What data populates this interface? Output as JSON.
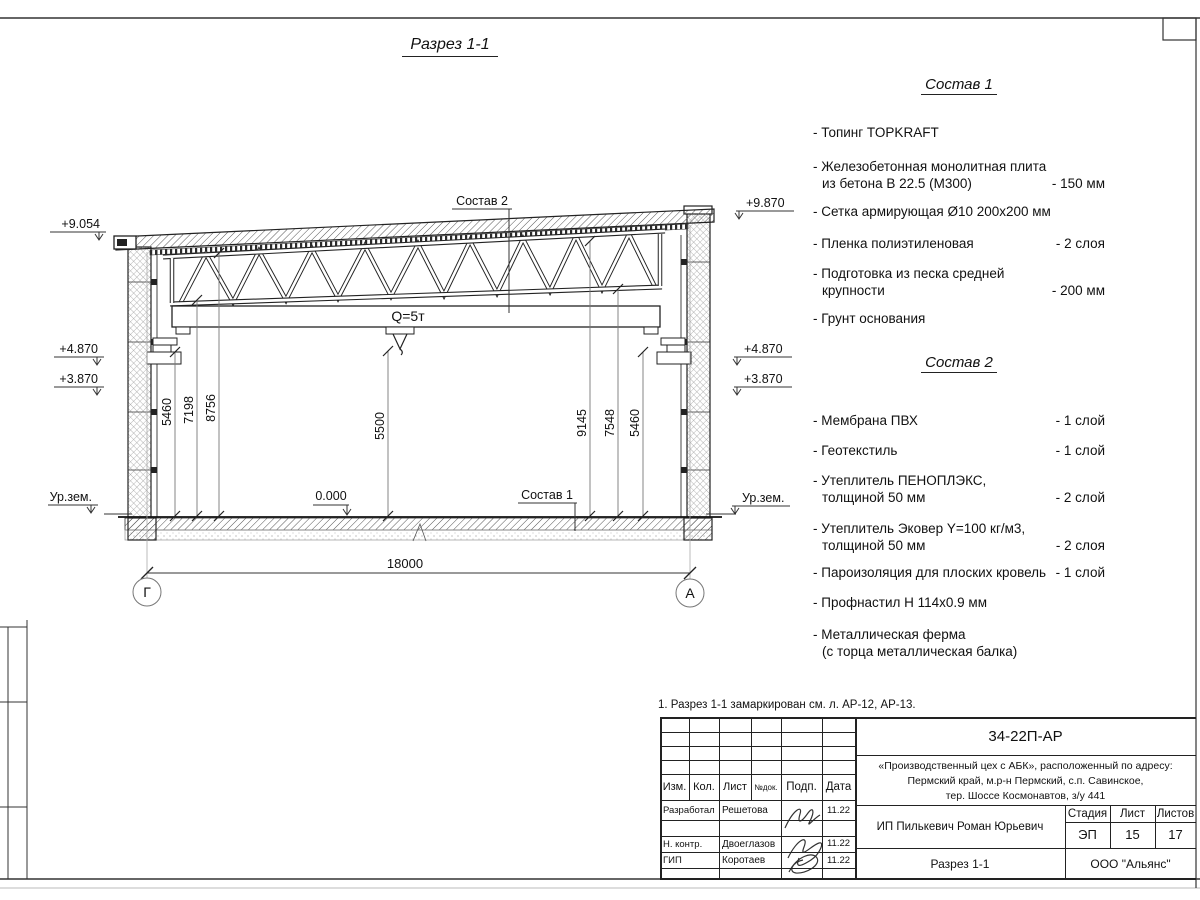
{
  "sheet": {
    "title": "Разрез 1-1",
    "note": "1. Разрез 1-1 замаркирован см. л. АР-12, АР-13."
  },
  "drawing": {
    "crane": "Q=5т",
    "span": "18000",
    "zero": "0.000",
    "axis_left": "Г",
    "axis_right": "А",
    "label_sostav1": "Состав 1",
    "label_sostav2": "Состав 2",
    "elev_left": [
      "+9.054",
      "+4.870",
      "+3.870",
      "Ур.зем."
    ],
    "elev_right": [
      "+9.870",
      "+4.870",
      "+3.870",
      "Ур.зем."
    ],
    "dims_left": [
      "5460",
      "7198",
      "8756"
    ],
    "dim_mid": "5500",
    "dims_right": [
      "9145",
      "7548",
      "5460"
    ]
  },
  "sostav1": {
    "title": "Состав 1",
    "items": [
      {
        "l1": "- Топинг TOPKRAFT",
        "l2": "",
        "value": ""
      },
      {
        "l1": "- Железобетонная  монолитная плита",
        "l2": "из бетона В 22.5 (М300)",
        "value": "- 150 мм"
      },
      {
        "l1": "- Сетка армирующая Ø10 200х200 мм",
        "l2": "",
        "value": ""
      },
      {
        "l1": "- Пленка полиэтиленовая",
        "l2": "",
        "value": "- 2 слоя"
      },
      {
        "l1": "- Подготовка из песка средней",
        "l2": "крупности",
        "value": "- 200 мм"
      },
      {
        "l1": "- Грунт основания",
        "l2": "",
        "value": ""
      }
    ]
  },
  "sostav2": {
    "title": "Состав 2",
    "items": [
      {
        "l1": "- Мембрана ПВХ",
        "l2": "",
        "value": "- 1 слой"
      },
      {
        "l1": "- Геотекстиль",
        "l2": "",
        "value": "- 1 слой"
      },
      {
        "l1": "- Утеплитель ПЕНОПЛЭКС,",
        "l2": "толщиной 50 мм",
        "value": "- 2 слой"
      },
      {
        "l1": "- Утеплитель Эковер Y=100 кг/м3,",
        "l2": "толщиной 50 мм",
        "value": "- 2 слоя"
      },
      {
        "l1": "- Пароизоляция для плоских кровель",
        "l2": "",
        "value": "- 1 слой"
      },
      {
        "l1": "- Профнастил Н 114х0.9 мм",
        "l2": "",
        "value": ""
      },
      {
        "l1": "- Металлическая ферма",
        "l2": "(с торца металлическая балка)",
        "value": ""
      }
    ]
  },
  "titleblock": {
    "doc_number": "34-22П-АР",
    "project": [
      "«Производственный цех с АБК», расположенный по адресу:",
      "Пермский край, м.р-н Пермский, с.п. Савинское,",
      "тер. Шоссе Космонавтов, з/у 441"
    ],
    "columns": [
      "Изм.",
      "Кол.",
      "Лист",
      "№док.",
      "Подп.",
      "Дата"
    ],
    "rows": [
      {
        "role": "Разработал",
        "name": "Решетова",
        "date": "11.22"
      },
      {
        "role": "Н. контр.",
        "name": "Двоеглазов",
        "date": "11.22"
      },
      {
        "role": "ГИП",
        "name": "Коротаев",
        "date": "11.22"
      }
    ],
    "client": "ИП Пилькевич Роман Юрьевич",
    "stage_label": "Стадия",
    "sheet_label": "Лист",
    "sheets_label": "Листов",
    "stage": "ЭП",
    "sheet": "15",
    "sheets": "17",
    "sheet_title": "Разрез 1-1",
    "company": "ООО \"Альянс\""
  }
}
